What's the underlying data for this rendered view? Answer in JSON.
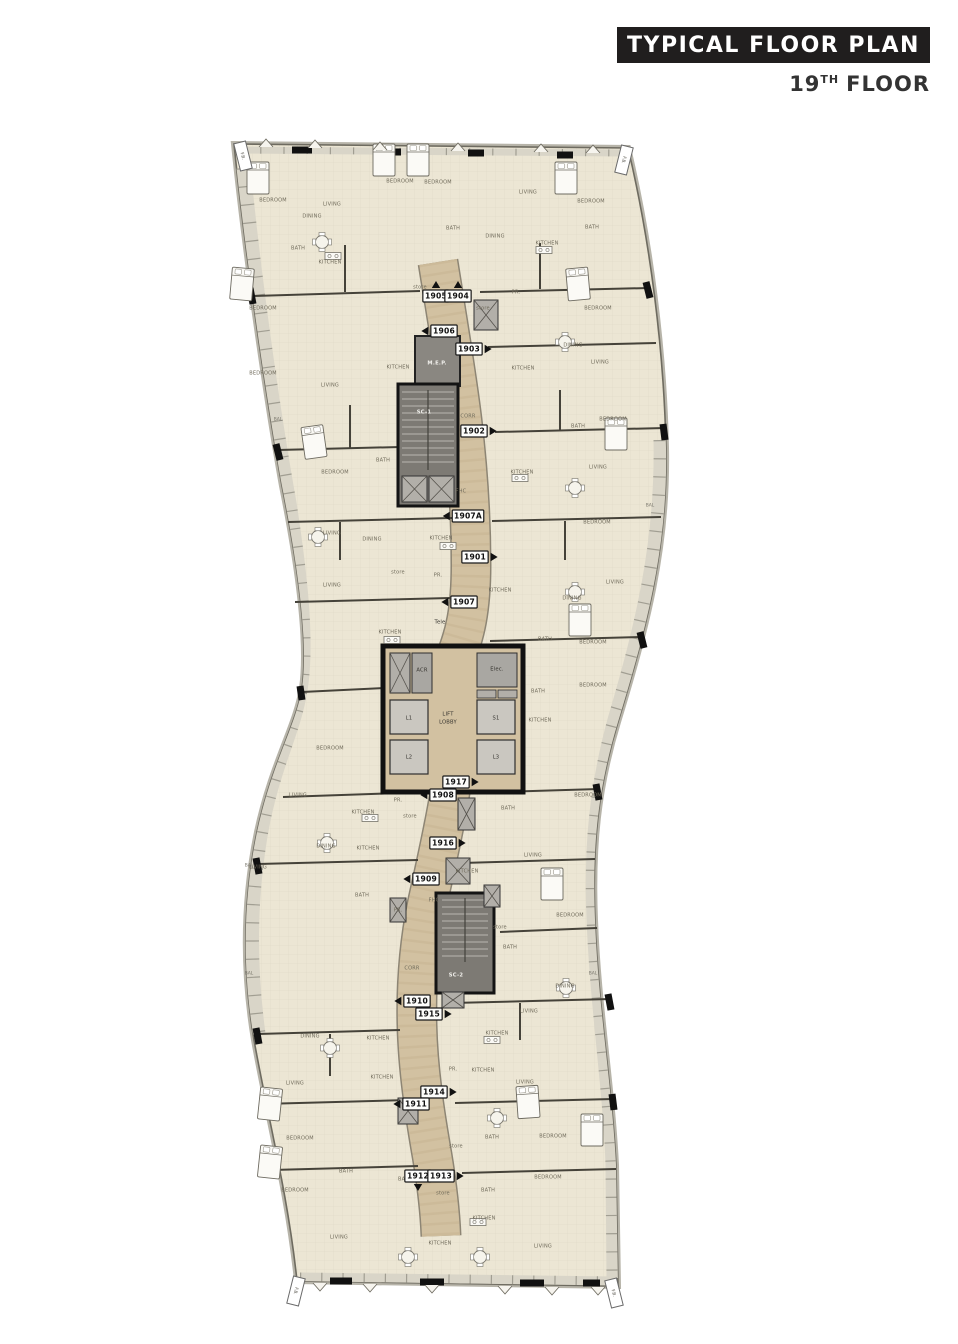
{
  "header": {
    "title": "TYPICAL FLOOR PLAN",
    "floor_number": "19",
    "floor_suffix": "TH",
    "floor_word": "FLOOR"
  },
  "colors": {
    "title_bar_bg": "#201e1e",
    "title_text": "#ffffff",
    "floor_text": "#333333",
    "unit_fill": "#ece6d4",
    "corridor": "#d2c1a1",
    "wall": "#454239",
    "core_gray": "#7d7a74",
    "balcony_band": "#d9d5c8",
    "tag_border": "#191919"
  },
  "plan": {
    "fb_label": "F.B.",
    "fb_tags": [
      {
        "x": 243,
        "y": 156,
        "angle": -14
      },
      {
        "x": 624,
        "y": 160,
        "angle": 14
      },
      {
        "x": 296,
        "y": 1291,
        "angle": 14
      },
      {
        "x": 614,
        "y": 1293,
        "angle": -14
      }
    ],
    "units": [
      {
        "id": "1905",
        "x": 436,
        "y": 296,
        "arrow": "up"
      },
      {
        "id": "1904",
        "x": 458,
        "y": 296,
        "arrow": "up"
      },
      {
        "id": "1906",
        "x": 444,
        "y": 331,
        "arrow": "left"
      },
      {
        "id": "1903",
        "x": 469,
        "y": 349,
        "arrow": "right"
      },
      {
        "id": "1902",
        "x": 474,
        "y": 431,
        "arrow": "right"
      },
      {
        "id": "1907A",
        "x": 468,
        "y": 516,
        "arrow": "left"
      },
      {
        "id": "1901",
        "x": 475,
        "y": 557,
        "arrow": "right"
      },
      {
        "id": "1907",
        "x": 464,
        "y": 602,
        "arrow": "left"
      },
      {
        "id": "1917",
        "x": 456,
        "y": 782,
        "arrow": "right"
      },
      {
        "id": "1908",
        "x": 443,
        "y": 795,
        "arrow": "left"
      },
      {
        "id": "1916",
        "x": 443,
        "y": 843,
        "arrow": "right"
      },
      {
        "id": "1909",
        "x": 426,
        "y": 879,
        "arrow": "left"
      },
      {
        "id": "1910",
        "x": 417,
        "y": 1001,
        "arrow": "left"
      },
      {
        "id": "1915",
        "x": 429,
        "y": 1014,
        "arrow": "right"
      },
      {
        "id": "1914",
        "x": 434,
        "y": 1092,
        "arrow": "right"
      },
      {
        "id": "1911",
        "x": 416,
        "y": 1104,
        "arrow": "left"
      },
      {
        "id": "1912",
        "x": 418,
        "y": 1176,
        "arrow": "down"
      },
      {
        "id": "1913",
        "x": 441,
        "y": 1176,
        "arrow": "right"
      }
    ],
    "labels": [
      {
        "t": "BEDROOM",
        "x": 273,
        "y": 200
      },
      {
        "t": "LIVING",
        "x": 332,
        "y": 204
      },
      {
        "t": "DINING",
        "x": 312,
        "y": 216
      },
      {
        "t": "BATH",
        "x": 298,
        "y": 248
      },
      {
        "t": "KITCHEN",
        "x": 330,
        "y": 262
      },
      {
        "t": "BEDROOM",
        "x": 400,
        "y": 181
      },
      {
        "t": "BEDROOM",
        "x": 438,
        "y": 182
      },
      {
        "t": "BATH",
        "x": 453,
        "y": 228
      },
      {
        "t": "DINING",
        "x": 495,
        "y": 236
      },
      {
        "t": "LIVING",
        "x": 528,
        "y": 192
      },
      {
        "t": "KITCHEN",
        "x": 547,
        "y": 243
      },
      {
        "t": "BEDROOM",
        "x": 591,
        "y": 201
      },
      {
        "t": "BATH",
        "x": 592,
        "y": 227
      },
      {
        "t": "BEDROOM",
        "x": 263,
        "y": 308
      },
      {
        "t": "store",
        "x": 420,
        "y": 287
      },
      {
        "t": "PR.",
        "x": 516,
        "y": 292
      },
      {
        "t": "store",
        "x": 483,
        "y": 308
      },
      {
        "t": "BEDROOM",
        "x": 598,
        "y": 308
      },
      {
        "t": "BEDROOM",
        "x": 263,
        "y": 373
      },
      {
        "t": "LIVING",
        "x": 330,
        "y": 385
      },
      {
        "t": "KITCHEN",
        "x": 398,
        "y": 367
      },
      {
        "t": "KITCHEN",
        "x": 523,
        "y": 368
      },
      {
        "t": "DINING",
        "x": 573,
        "y": 345
      },
      {
        "t": "LIVING",
        "x": 600,
        "y": 362
      },
      {
        "t": "BEDROOM",
        "x": 613,
        "y": 419
      },
      {
        "t": "BATH",
        "x": 578,
        "y": 426
      },
      {
        "t": "LIVING",
        "x": 598,
        "y": 467
      },
      {
        "t": "KITCHEN",
        "x": 522,
        "y": 472
      },
      {
        "t": "BEDROOM",
        "x": 335,
        "y": 472
      },
      {
        "t": "BATH",
        "x": 383,
        "y": 460
      },
      {
        "t": "LIVING",
        "x": 332,
        "y": 533
      },
      {
        "t": "DINING",
        "x": 372,
        "y": 539
      },
      {
        "t": "KITCHEN",
        "x": 441,
        "y": 538
      },
      {
        "t": "BEDROOM",
        "x": 597,
        "y": 522
      },
      {
        "t": "LIVING",
        "x": 615,
        "y": 582
      },
      {
        "t": "DINING",
        "x": 572,
        "y": 598
      },
      {
        "t": "store",
        "x": 398,
        "y": 572
      },
      {
        "t": "PR.",
        "x": 438,
        "y": 575
      },
      {
        "t": "LIVING",
        "x": 332,
        "y": 585
      },
      {
        "t": "KITCHEN",
        "x": 500,
        "y": 590
      },
      {
        "t": "BEDROOM",
        "x": 593,
        "y": 642
      },
      {
        "t": "BATH",
        "x": 545,
        "y": 639
      },
      {
        "t": "KITCHEN",
        "x": 390,
        "y": 632
      },
      {
        "t": "BEDROOM",
        "x": 593,
        "y": 685
      },
      {
        "t": "KITCHEN",
        "x": 540,
        "y": 720
      },
      {
        "t": "BATH",
        "x": 538,
        "y": 691
      },
      {
        "t": "BEDROOM",
        "x": 330,
        "y": 748
      },
      {
        "t": "BEDROOM",
        "x": 588,
        "y": 795
      },
      {
        "t": "LIVING",
        "x": 298,
        "y": 795
      },
      {
        "t": "KITCHEN",
        "x": 363,
        "y": 812
      },
      {
        "t": "store",
        "x": 410,
        "y": 816
      },
      {
        "t": "PR.",
        "x": 398,
        "y": 800
      },
      {
        "t": "BATH",
        "x": 508,
        "y": 808
      },
      {
        "t": "DINING",
        "x": 326,
        "y": 846
      },
      {
        "t": "KITCHEN",
        "x": 368,
        "y": 848
      },
      {
        "t": "LIVING",
        "x": 533,
        "y": 855
      },
      {
        "t": "LIVING",
        "x": 258,
        "y": 867
      },
      {
        "t": "KITCHEN",
        "x": 467,
        "y": 871
      },
      {
        "t": "BATH",
        "x": 362,
        "y": 895
      },
      {
        "t": "PR.",
        "x": 398,
        "y": 910
      },
      {
        "t": "BEDROOM",
        "x": 570,
        "y": 915
      },
      {
        "t": "store",
        "x": 500,
        "y": 927
      },
      {
        "t": "BATH",
        "x": 510,
        "y": 947
      },
      {
        "t": "DINING",
        "x": 565,
        "y": 986
      },
      {
        "t": "LIVING",
        "x": 529,
        "y": 1011
      },
      {
        "t": "KITCHEN",
        "x": 497,
        "y": 1033
      },
      {
        "t": "DINING",
        "x": 310,
        "y": 1036
      },
      {
        "t": "KITCHEN",
        "x": 378,
        "y": 1038
      },
      {
        "t": "PR.",
        "x": 453,
        "y": 1069
      },
      {
        "t": "KITCHEN",
        "x": 483,
        "y": 1070
      },
      {
        "t": "LIVING",
        "x": 295,
        "y": 1083
      },
      {
        "t": "KITCHEN",
        "x": 382,
        "y": 1077
      },
      {
        "t": "LIVING",
        "x": 525,
        "y": 1082
      },
      {
        "t": "BEDROOM",
        "x": 300,
        "y": 1138
      },
      {
        "t": "BEDROOM",
        "x": 553,
        "y": 1136
      },
      {
        "t": "store",
        "x": 456,
        "y": 1146
      },
      {
        "t": "BATH",
        "x": 492,
        "y": 1137
      },
      {
        "t": "BATH",
        "x": 346,
        "y": 1171
      },
      {
        "t": "BATH",
        "x": 405,
        "y": 1179
      },
      {
        "t": "BEDROOM",
        "x": 295,
        "y": 1190
      },
      {
        "t": "BEDROOM",
        "x": 548,
        "y": 1177
      },
      {
        "t": "BATH",
        "x": 488,
        "y": 1190
      },
      {
        "t": "store",
        "x": 443,
        "y": 1193
      },
      {
        "t": "KITCHEN",
        "x": 484,
        "y": 1218
      },
      {
        "t": "LIVING",
        "x": 339,
        "y": 1237
      },
      {
        "t": "KITCHEN",
        "x": 440,
        "y": 1243
      },
      {
        "t": "LIVING",
        "x": 543,
        "y": 1246
      },
      {
        "t": "BAL",
        "x": 278,
        "y": 419,
        "k": "bal"
      },
      {
        "t": "BAL",
        "x": 650,
        "y": 505,
        "k": "bal"
      },
      {
        "t": "BAL",
        "x": 249,
        "y": 865,
        "k": "bal"
      },
      {
        "t": "BAL",
        "x": 249,
        "y": 973,
        "k": "bal"
      },
      {
        "t": "BAL",
        "x": 593,
        "y": 973,
        "k": "bal"
      },
      {
        "t": "CORR",
        "x": 468,
        "y": 416
      },
      {
        "t": "CORR",
        "x": 412,
        "y": 968
      },
      {
        "t": "FHC",
        "x": 461,
        "y": 491
      },
      {
        "t": "FHC",
        "x": 434,
        "y": 900
      },
      {
        "t": "M.E.P.",
        "x": 437,
        "y": 363,
        "k": "core-light"
      },
      {
        "t": "SC-1",
        "x": 424,
        "y": 412,
        "k": "core-light"
      },
      {
        "t": "SC-2",
        "x": 456,
        "y": 975,
        "k": "core-light"
      },
      {
        "t": "LIFT",
        "x": 448,
        "y": 714,
        "k": "core-dark"
      },
      {
        "t": "LOBBY",
        "x": 448,
        "y": 722,
        "k": "core-dark"
      },
      {
        "t": "L1",
        "x": 409,
        "y": 718,
        "k": "core-dark"
      },
      {
        "t": "L2",
        "x": 409,
        "y": 757,
        "k": "core-dark"
      },
      {
        "t": "S1",
        "x": 496,
        "y": 718,
        "k": "core-dark"
      },
      {
        "t": "L3",
        "x": 496,
        "y": 757,
        "k": "core-dark"
      },
      {
        "t": "Elec.",
        "x": 497,
        "y": 669,
        "k": "core-dark"
      },
      {
        "t": "ACR",
        "x": 422,
        "y": 670,
        "k": "core-dark"
      },
      {
        "t": "Tele",
        "x": 440,
        "y": 622,
        "k": "core-dark"
      }
    ]
  }
}
